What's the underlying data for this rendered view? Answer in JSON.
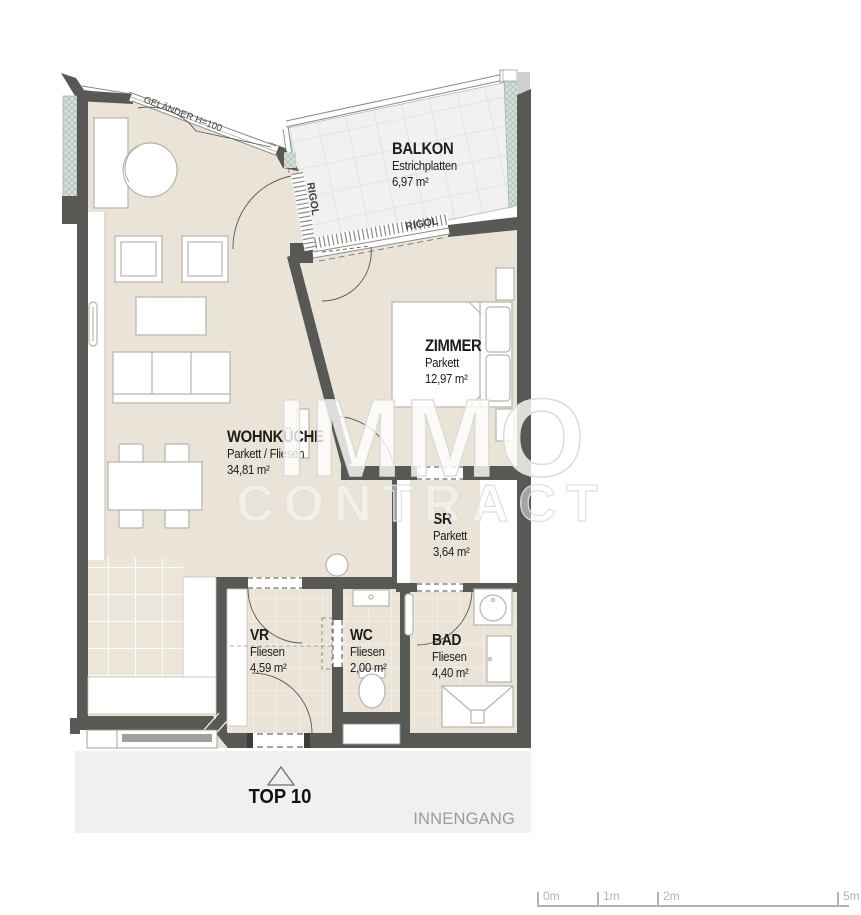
{
  "plan": {
    "rooms": [
      {
        "id": "balkon",
        "name": "BALKON",
        "material": "Estrichplatten",
        "area": "6,97 m²"
      },
      {
        "id": "zimmer",
        "name": "ZIMMER",
        "material": "Parkett",
        "area": "12,97 m²"
      },
      {
        "id": "wohnkueche",
        "name": "WOHNKÜCHE",
        "material": "Parkett / Fliesen",
        "area": "34,81 m²"
      },
      {
        "id": "sr",
        "name": "SR",
        "material": "Parkett",
        "area": "3,64 m²"
      },
      {
        "id": "vr",
        "name": "VR",
        "material": "Fliesen",
        "area": "4,59 m²"
      },
      {
        "id": "wc",
        "name": "WC",
        "material": "Fliesen",
        "area": "2,00 m²"
      },
      {
        "id": "bad",
        "name": "BAD",
        "material": "Fliesen",
        "area": "4,40 m²"
      }
    ],
    "annotations": {
      "railing": "GELÄNDER H=100",
      "rigol_left": "RIGOL",
      "rigol_bottom": "RIGOL"
    },
    "unit_label": "TOP 10",
    "entrance_label": "INNENGANG",
    "watermark": {
      "line1": "IMMO",
      "line2": "CONTRACT"
    },
    "scale_bar": {
      "ticks": [
        "0m",
        "1m",
        "2m",
        "5m"
      ]
    },
    "colors": {
      "floor": "#e9e4d7",
      "wall": "#585855",
      "insulation": "#d6dfda",
      "balcony_tile": "#f1f1ef",
      "strip": "#f0f0ef",
      "muted_text": "#9b9b99",
      "scale": "#b3b3b0"
    }
  }
}
